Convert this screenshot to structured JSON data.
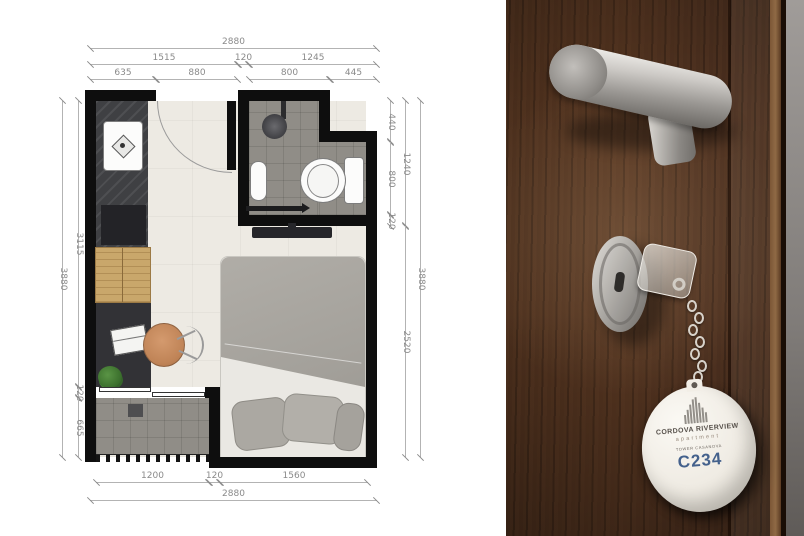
{
  "floor_plan": {
    "dims": {
      "t1": "2880",
      "t2a": "1515",
      "t2b": "120",
      "t2c": "1245",
      "t3a": "635",
      "t3b": "880",
      "t3c": "800",
      "t3d": "445",
      "b1a": "1200",
      "b1b": "120",
      "b1c": "1560",
      "b2": "2880",
      "l1": "3115",
      "l2": "120",
      "l3": "665",
      "l4": "3880",
      "r1": "440",
      "r2": "800",
      "r3": "120",
      "r4": "1240",
      "r5": "2520",
      "r6": "3880"
    }
  },
  "key_tag": {
    "brand_line1": "CORDOVA RIVERVIEW",
    "brand_line2": "apartment",
    "tower_line": "TOWER CASANOVA",
    "unit_number": "C234",
    "unit_number_color": "#44618c",
    "fob_color": "#f1ede5"
  },
  "photo_colors": {
    "door_wood": "#50331f",
    "wall_gray": "#8f8b88",
    "hardware_metal": "#b5b2ae"
  }
}
